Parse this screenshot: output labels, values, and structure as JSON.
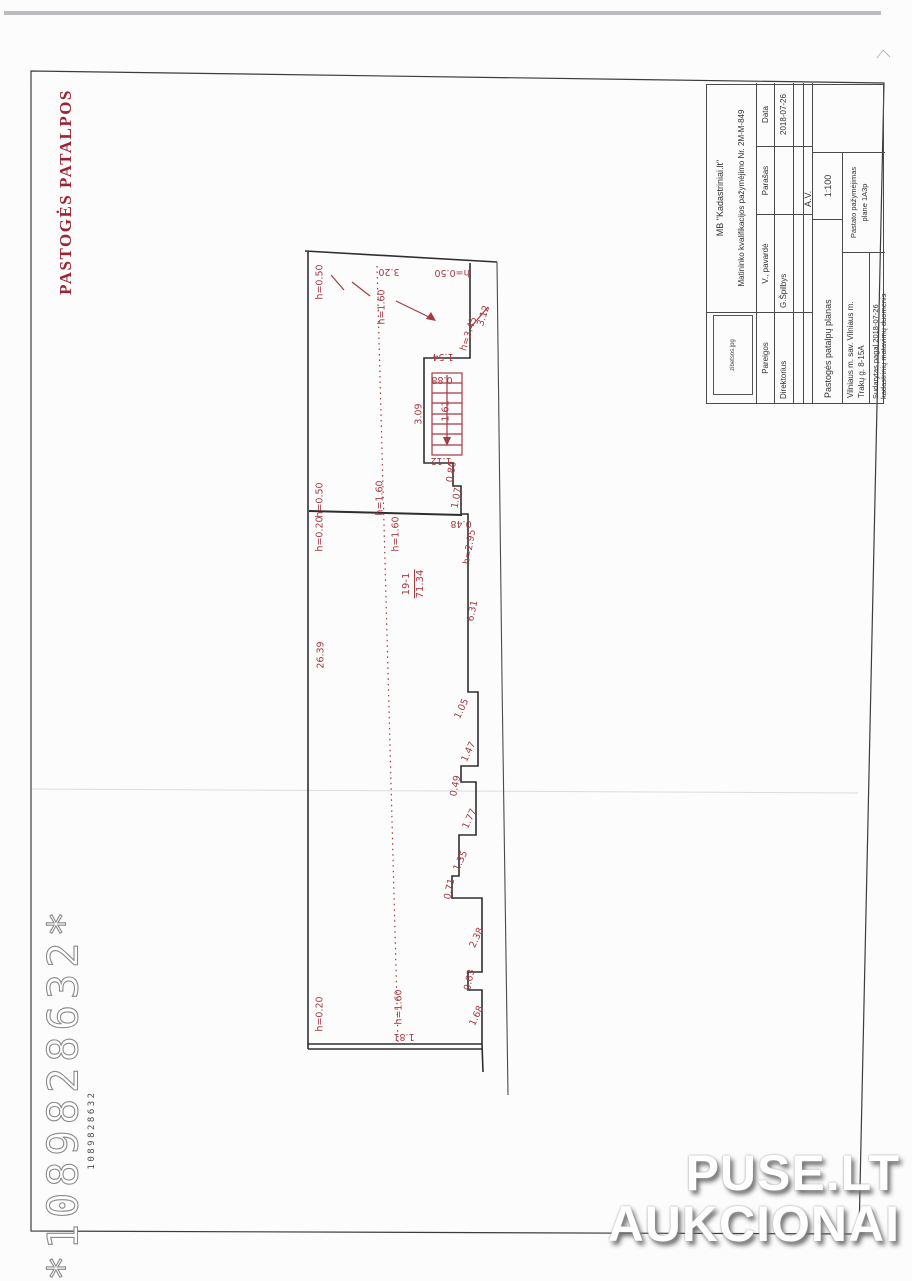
{
  "page": {
    "title_vertical": "PASTOGĖS PATALPOS",
    "barcode_large": "*1089828632*",
    "barcode_small": "1089828632",
    "watermark_line1": "PUSE.LT",
    "watermark_line2": "AUKCIONAI"
  },
  "title_block": {
    "logo_text": "zibetsos.jpg",
    "company": "MB \"Kadastriniai.lt\"",
    "qualification": "Matininko kvalifikacijos pažymėjimo Nr. 2M-M-849",
    "col_pareigos": "Pareigos",
    "col_pavarde": "V., pavardė",
    "col_parasas": "Parašas",
    "col_data": "Data",
    "row_position": "Direktorius",
    "row_name": "G.Špilbys",
    "row_date": "2018-07-26",
    "stamp": "A.V.",
    "plan_name": "Pastogės patalpų planas",
    "scale": "1:100",
    "address_line1": "Vilniaus m. sav. Vilniaus m.",
    "address_line2": "Trakų g. 8-15A",
    "basis_line1": "Sudarytas pagal 2018-07-26",
    "basis_line2": "kadastrinių matavimų duomenis",
    "building_label_line1": "Pastato pažymėjimas",
    "building_label_line2": "plane  1A3p"
  },
  "plan": {
    "room": {
      "number": "19-1",
      "area": "71.34"
    },
    "colors": {
      "red": "#a63a42",
      "line": "#2e2e2e"
    },
    "labels": [
      {
        "t": "h=0.50",
        "x": 320,
        "y": 282,
        "r": -90
      },
      {
        "t": "3.20",
        "x": 389,
        "y": 271,
        "r": 180
      },
      {
        "t": "h=0.50",
        "x": 452,
        "y": 272,
        "r": 180
      },
      {
        "t": "h=1.60",
        "x": 382,
        "y": 307,
        "r": -90
      },
      {
        "t": "3.12",
        "x": 484,
        "y": 316,
        "r": -72
      },
      {
        "t": "h=3.45",
        "x": 469,
        "y": 334,
        "r": -72
      },
      {
        "t": "1.54",
        "x": 443,
        "y": 356,
        "r": 180
      },
      {
        "t": "0.88",
        "x": 442,
        "y": 379,
        "r": 180
      },
      {
        "t": "3.09",
        "x": 419,
        "y": 414,
        "r": -90
      },
      {
        "t": "1.61",
        "x": 446,
        "y": 411,
        "r": -90
      },
      {
        "t": "1.12",
        "x": 441,
        "y": 460,
        "r": 180
      },
      {
        "t": "0.80",
        "x": 452,
        "y": 472,
        "r": -80
      },
      {
        "t": "1.07",
        "x": 457,
        "y": 498,
        "r": -80
      },
      {
        "t": "h=0.50",
        "x": 320,
        "y": 500,
        "r": -90
      },
      {
        "t": "h=1.60",
        "x": 380,
        "y": 498,
        "r": -90
      },
      {
        "t": "h=0.20",
        "x": 320,
        "y": 534,
        "r": -90
      },
      {
        "t": "h=1.60",
        "x": 396,
        "y": 534,
        "r": -90
      },
      {
        "t": "0.48",
        "x": 461,
        "y": 523,
        "r": 180
      },
      {
        "t": "h=2.95",
        "x": 470,
        "y": 547,
        "r": -80
      },
      {
        "t": "6.31",
        "x": 473,
        "y": 611,
        "r": -78
      },
      {
        "t": "26.39",
        "x": 321,
        "y": 655,
        "r": -90
      },
      {
        "t": "1.05",
        "x": 462,
        "y": 709,
        "r": -65
      },
      {
        "t": "1.47",
        "x": 469,
        "y": 752,
        "r": -65
      },
      {
        "t": "0.49",
        "x": 456,
        "y": 786,
        "r": -78
      },
      {
        "t": "1.77",
        "x": 470,
        "y": 819,
        "r": -65
      },
      {
        "t": "1.35",
        "x": 461,
        "y": 861,
        "r": -65
      },
      {
        "t": "0.71",
        "x": 450,
        "y": 889,
        "r": -78
      },
      {
        "t": "2.38",
        "x": 477,
        "y": 938,
        "r": -65
      },
      {
        "t": "0.63",
        "x": 470,
        "y": 980,
        "r": -78
      },
      {
        "t": "1.68",
        "x": 477,
        "y": 1016,
        "r": -65
      },
      {
        "t": "h=0.20",
        "x": 320,
        "y": 1014,
        "r": -90
      },
      {
        "t": "h=1.60",
        "x": 399,
        "y": 1007,
        "r": -90
      },
      {
        "t": "1.81",
        "x": 404,
        "y": 1036,
        "r": 180
      }
    ]
  }
}
